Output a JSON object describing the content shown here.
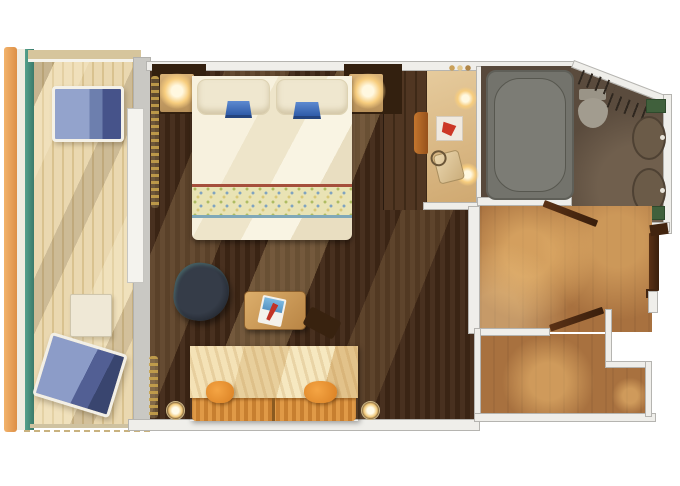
{
  "floor_plan": {
    "type": "cruise-ship-balcony-stateroom",
    "rooms": [
      {
        "id": "balcony",
        "label": "Balcony",
        "features": [
          "railing",
          "teak-deck",
          "lounge-chair",
          "lounge-chair",
          "side-table"
        ]
      },
      {
        "id": "stateroom",
        "label": "Stateroom",
        "features": [
          "king-bed",
          "pillows",
          "blue-fan-decor",
          "nightstand-with-lamp",
          "nightstand-with-lamp",
          "wardrobe",
          "vanity-desk",
          "vanity-stool",
          "vanity-lamps",
          "framed-art",
          "handbag",
          "armchair",
          "coffee-table",
          "magazine",
          "sofa",
          "throw-pillow",
          "throw-pillow",
          "wall-sconce",
          "wall-sconce",
          "curtains"
        ]
      },
      {
        "id": "bathroom",
        "label": "Bathroom",
        "features": [
          "bathtub",
          "toilet",
          "towel-racks",
          "sink",
          "sink",
          "bath-mat",
          "bath-mat"
        ]
      },
      {
        "id": "entry",
        "label": "Entry Hall",
        "features": [
          "entry-door",
          "bathroom-door",
          "vestibule-door"
        ]
      }
    ],
    "palette": {
      "background": "#ffffff",
      "wall": "#efeeea",
      "wall_edge": "#b5b4b0",
      "balcony_deck": "#ead8b0",
      "railing_orange": "#e9a25a",
      "railing_teal": "#48917f",
      "cabin_floor_dark": "#412a1b",
      "corridor_floor": "#a8713f",
      "bathroom_floor": "#57483b",
      "bathtub_gray": "#73736c",
      "bed_cream": "#f7f1de",
      "accent_blue": "#4a72b8",
      "lounger_blue": "#8c9cc8",
      "sofa_orange": "#e09a47",
      "pillow_orange": "#f09a3a",
      "door_wood": "#4a2817",
      "curtain_gold": "#c9a44e",
      "lamp_glow": "#f7cd7e",
      "mat_green": "#40603c"
    }
  }
}
